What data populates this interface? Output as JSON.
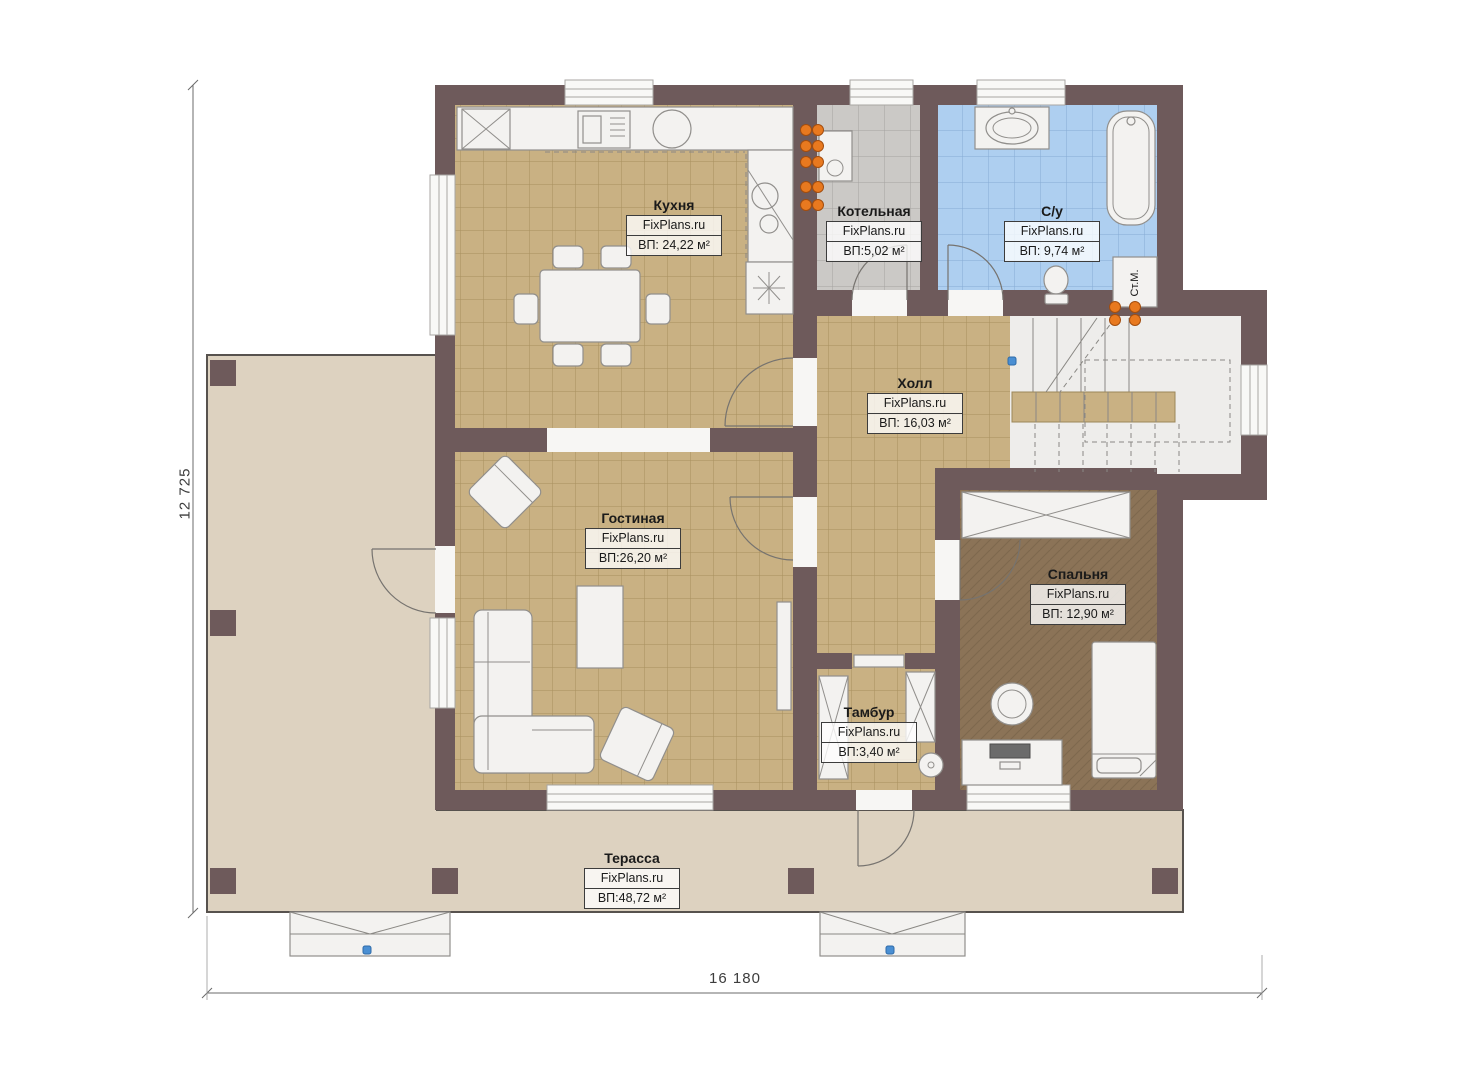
{
  "dimensions": {
    "height_label": "12 725",
    "width_label": "16 180"
  },
  "rooms": {
    "kitchen": {
      "name": "Кухня",
      "site": "FixPlans.ru",
      "area": "ВП: 24,22 м²"
    },
    "boiler": {
      "name": "Котельная",
      "site": "FixPlans.ru",
      "area": "ВП:5,02 м²"
    },
    "bathroom": {
      "name": "С/у",
      "site": "FixPlans.ru",
      "area": "ВП: 9,74 м²"
    },
    "hall": {
      "name": "Холл",
      "site": "FixPlans.ru",
      "area": "ВП: 16,03 м²"
    },
    "living": {
      "name": "Гостиная",
      "site": "FixPlans.ru",
      "area": "ВП:26,20 м²"
    },
    "bedroom": {
      "name": "Спальня",
      "site": "FixPlans.ru",
      "area": "ВП: 12,90 м²"
    },
    "vestibule": {
      "name": "Тамбур",
      "site": "FixPlans.ru",
      "area": "ВП:3,40 м²"
    },
    "terrace": {
      "name": "Терасса",
      "site": "FixPlans.ru",
      "area": "ВП:48,72 м²"
    }
  },
  "labels": {
    "washing_machine": "Ст.М."
  },
  "colors": {
    "wall": "#6e5a5b",
    "floor_tile_tan": "#c9b183",
    "floor_tile_gray": "#cbc9c6",
    "floor_tile_blue": "#aecff0",
    "floor_bedroom": "#8b7357",
    "terrace": "#ddd2c0",
    "radiator_orange": "#e8791f",
    "marker_blue": "#4a8fd3",
    "label_text": "#1a1a1a"
  }
}
